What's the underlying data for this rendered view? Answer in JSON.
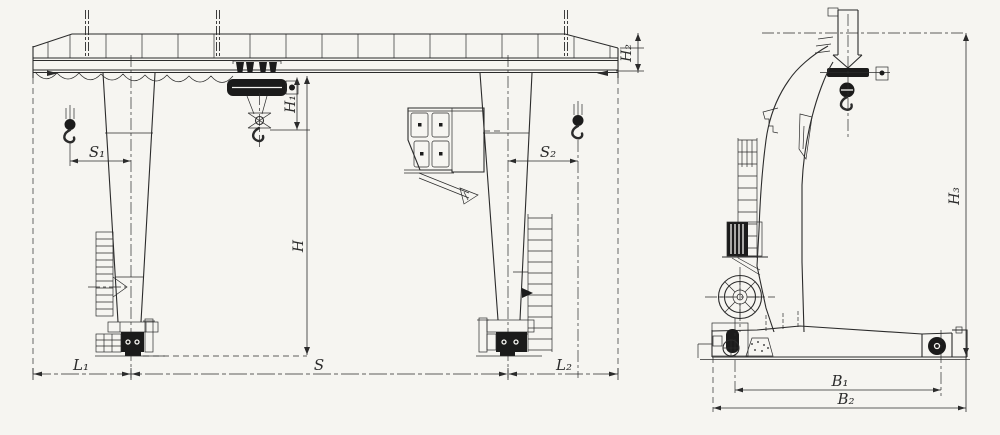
{
  "labels": {
    "front": {
      "s1": "S₁",
      "s2": "S₂",
      "h": "H",
      "h1": "H₁",
      "h2": "H₂",
      "s": "S",
      "l1": "L₁",
      "l2": "L₂"
    },
    "side": {
      "h3": "H₃",
      "b1": "B₁",
      "b2": "B₂"
    }
  },
  "colors": {
    "line": "#2b2b2b",
    "paper": "#f6f5f1",
    "dark": "#1b1b1b"
  }
}
